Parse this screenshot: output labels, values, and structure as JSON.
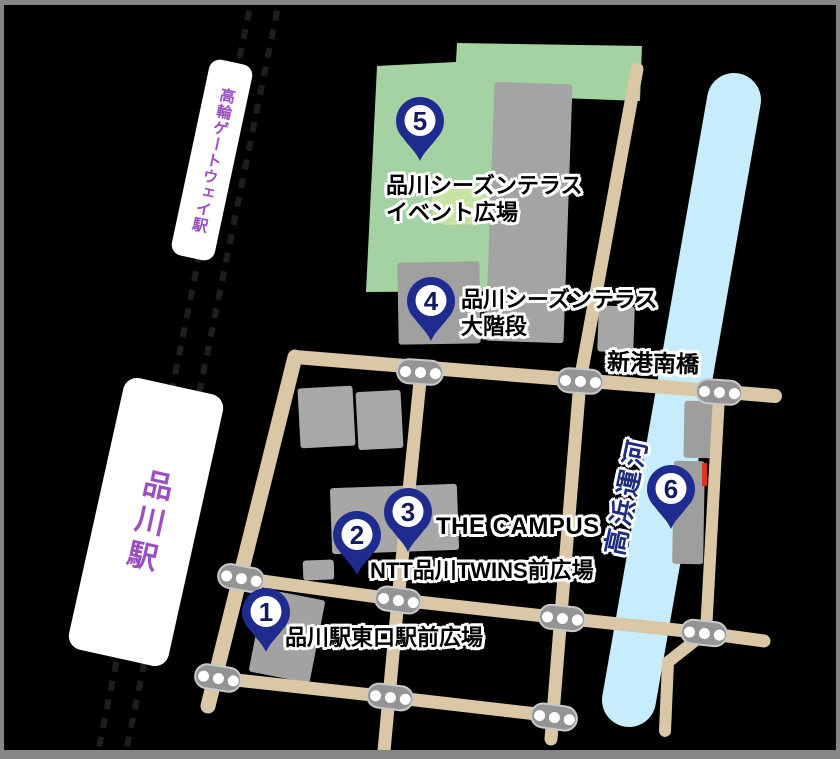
{
  "stations": [
    {
      "name": "高輪ゲートウェイ駅"
    },
    {
      "name": "品川駅"
    }
  ],
  "pins": [
    {
      "number": "1",
      "place": "品川駅東口駅前広場"
    },
    {
      "number": "2",
      "place": "NTT品川TWINS前広場"
    },
    {
      "number": "3",
      "place": "THE CAMPUS"
    },
    {
      "number": "4",
      "place_line1": "品川シーズンテラス",
      "place_line2": "大階段"
    },
    {
      "number": "5",
      "place_line1": "品川シーズンテラス",
      "place_line2": "イベント広場"
    },
    {
      "number": "6"
    }
  ],
  "labels": {
    "bridge": "新港南橋",
    "canal": "高浜運河"
  },
  "colors": {
    "background": "#000000",
    "road": "#d9c7a5",
    "park_green": "#a5d2a2",
    "park_light_patch": "#c7e4a3",
    "canal_blue": "#c7ecfb",
    "pin_navy": "#1e2b8f",
    "pin_number": "#131a5e",
    "station_purple": "#9b4fc1",
    "building_gray": "#a5a5a5",
    "crosswalk_gray": "#949494",
    "label_text": "#000000",
    "label_outline": "#ffffff",
    "railway_dash": "#1e1e1e",
    "frame_gray": "#868686",
    "red_mark": "#dd3322"
  }
}
